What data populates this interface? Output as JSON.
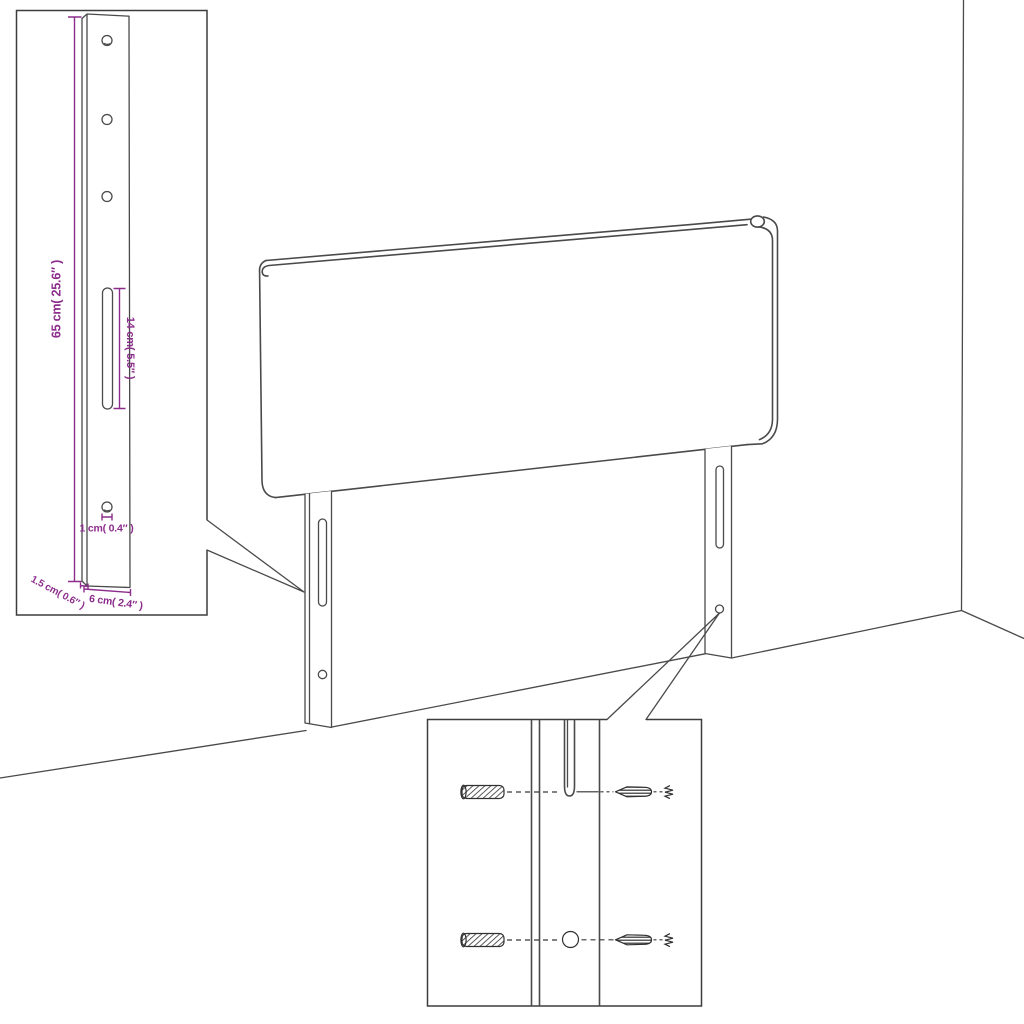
{
  "diagram": {
    "detail_inset": {
      "dimension_labels": {
        "bracket_height": "65 cm( 25.6″ )",
        "slot_length": "14 cm( 5.5″ )",
        "hole_diameter": "1 cm( 0.4″ )",
        "bracket_thickness": "1.5 cm( 0.6″ )",
        "bracket_width": "6 cm( 2.4″ )"
      }
    },
    "colors": {
      "line": "#4a4a4a",
      "dimension": "#8c2d8c",
      "background": "#ffffff"
    }
  }
}
